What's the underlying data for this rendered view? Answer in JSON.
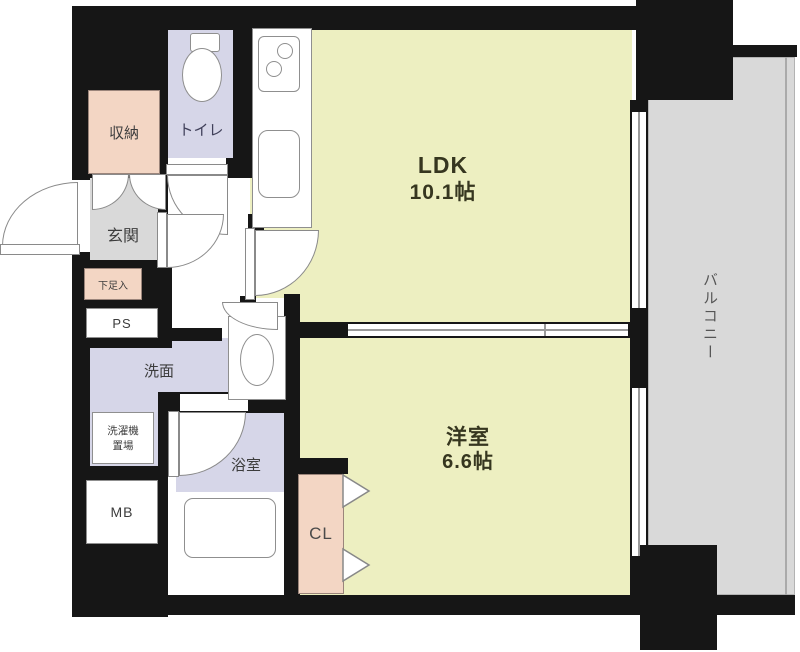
{
  "diagram_type": "japanese apartment floor plan",
  "rooms": {
    "ldk": {
      "label": "LDK",
      "size": "10.1帖"
    },
    "western_room": {
      "label": "洋室",
      "size": "6.6帖"
    },
    "balcony": {
      "label": "バルコニー"
    },
    "entrance": {
      "label": "玄関"
    },
    "toilet": {
      "label": "トイレ"
    },
    "storage": {
      "label": "収納"
    },
    "washroom": {
      "label": "洗面"
    },
    "bathroom": {
      "label": "浴室"
    },
    "closet": {
      "label": "CL"
    },
    "pipe_space": {
      "label": "PS"
    },
    "meter_box": {
      "label": "MB"
    },
    "shoe_cabinet": {
      "label": "下足入"
    },
    "laundry": {
      "label_line1": "洗濯機",
      "label_line2": "置場"
    }
  },
  "colors": {
    "room_yellow": "#edefc1",
    "room_lavender": "#d6d6e8",
    "room_pink": "#f3d6c4",
    "floor_gray": "#d9d9d9",
    "wall_black": "#161616"
  }
}
